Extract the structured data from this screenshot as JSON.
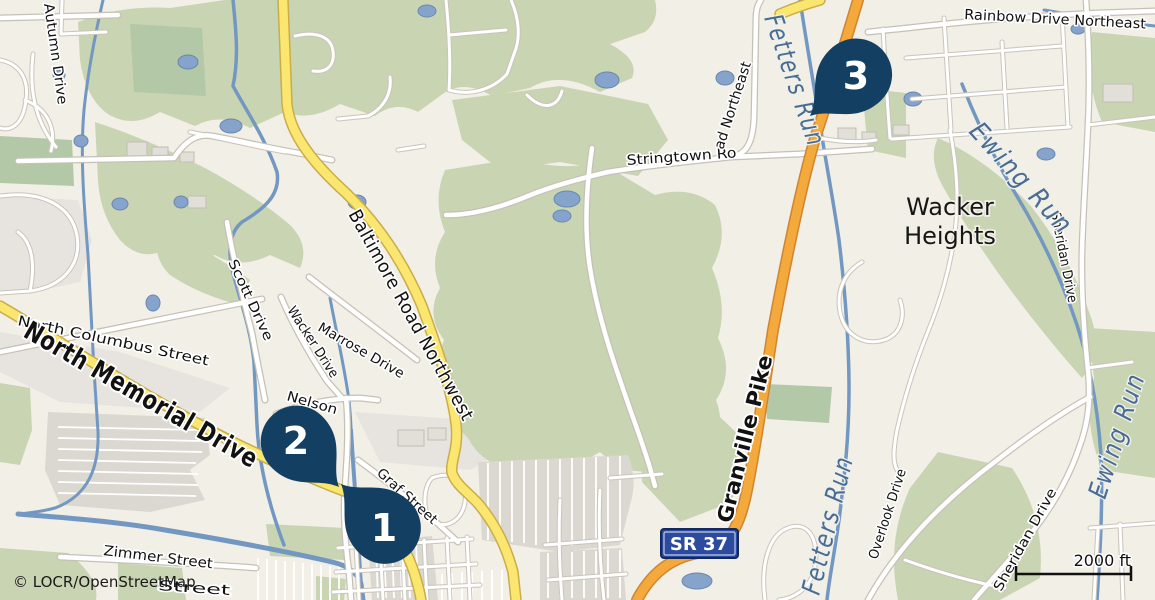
{
  "map": {
    "attribution": "© LOCR/OpenStreetMap",
    "scale": {
      "label": "2000 ft"
    },
    "route_badge": {
      "text": "SR 37"
    },
    "place_labels": {
      "wacker_heights_line1": "Wacker",
      "wacker_heights_line2": "Heights"
    },
    "road_labels": {
      "north_memorial_drive": "North Memorial Drive",
      "baltimore_road_northwest": "Baltimore Road Northwest",
      "granville_pike": "Granville Pike",
      "north_columbus_street": "North Columbus Street",
      "autumn_drive": "Autumn Drive",
      "scott_drive": "Scott Drive",
      "wacker_drive": "Wacker Drive",
      "marrose_drive": "Marrose Drive",
      "nelson": "Nelson",
      "graf_street": "Graf Street",
      "zimmer_street": "Zimmer Street",
      "hidden_street": "Street",
      "stringtown_part1": "Stringtown Ro",
      "stringtown_part2": "ad Northeast",
      "rainbow_drive_northeast": "Rainbow Drive Northeast",
      "sheridan_drive": "Sheridan Drive",
      "overlook_drive": "Overlook Drive"
    },
    "water_labels": {
      "fetters_run": "Fetters Run",
      "ewing_run": "Ewing Run"
    },
    "markers": [
      {
        "number": "1"
      },
      {
        "number": "2"
      },
      {
        "number": "3"
      }
    ],
    "colors": {
      "land": "#f2efe7",
      "forest_green": "#c9d4b3",
      "dark_green": "#b3c8a6",
      "yellow_road": "#fbe76f",
      "orange_road": "#f4a93c",
      "water": "#7298c2",
      "water_label": "#4a6b92",
      "marker_navy": "#133f63",
      "badge_blue": "#2d4b9e"
    }
  }
}
